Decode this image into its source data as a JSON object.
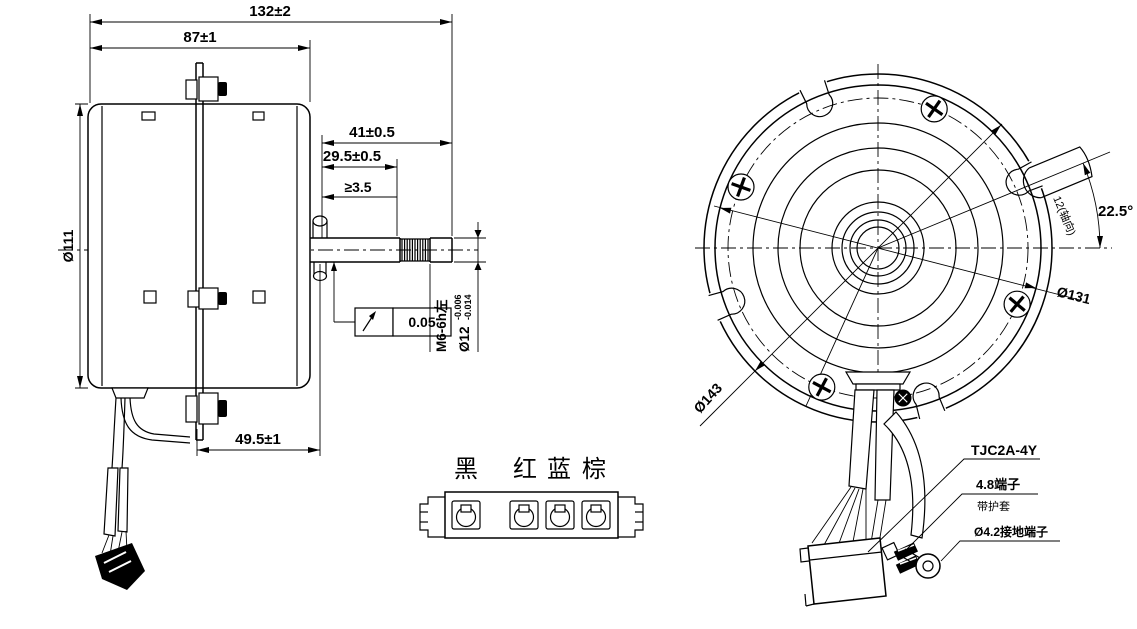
{
  "side_view": {
    "overall_length": "132±2",
    "body_length": "87±1",
    "body_diameter": "Ø111",
    "shaft_extension": "41±0.5",
    "shaft_step": "29.5±0.5",
    "thread_min_length": "≥3.5",
    "bracket_offset": "49.5±1",
    "thread_spec": "M6-6h左",
    "shaft_diameter": "Ø12",
    "shaft_tolerance_upper": "-0.006",
    "shaft_tolerance_lower": "-0.014",
    "runout_tolerance": "0.05"
  },
  "connector_view": {
    "wire_labels": [
      "黑",
      "红",
      "蓝",
      "棕"
    ]
  },
  "front_view": {
    "mount_angle": "22.5°",
    "boss_note": "12(轴向)",
    "body_diameter": "Ø131",
    "flange_diameter": "Ø143",
    "connector_model": "TJC2A-4Y",
    "terminal_note": "4.8端子",
    "sleeve_note": "带护套",
    "ground_terminal_note": "Ø4.2接地端子"
  },
  "colors": {
    "line": "#000000",
    "background": "#ffffff"
  }
}
